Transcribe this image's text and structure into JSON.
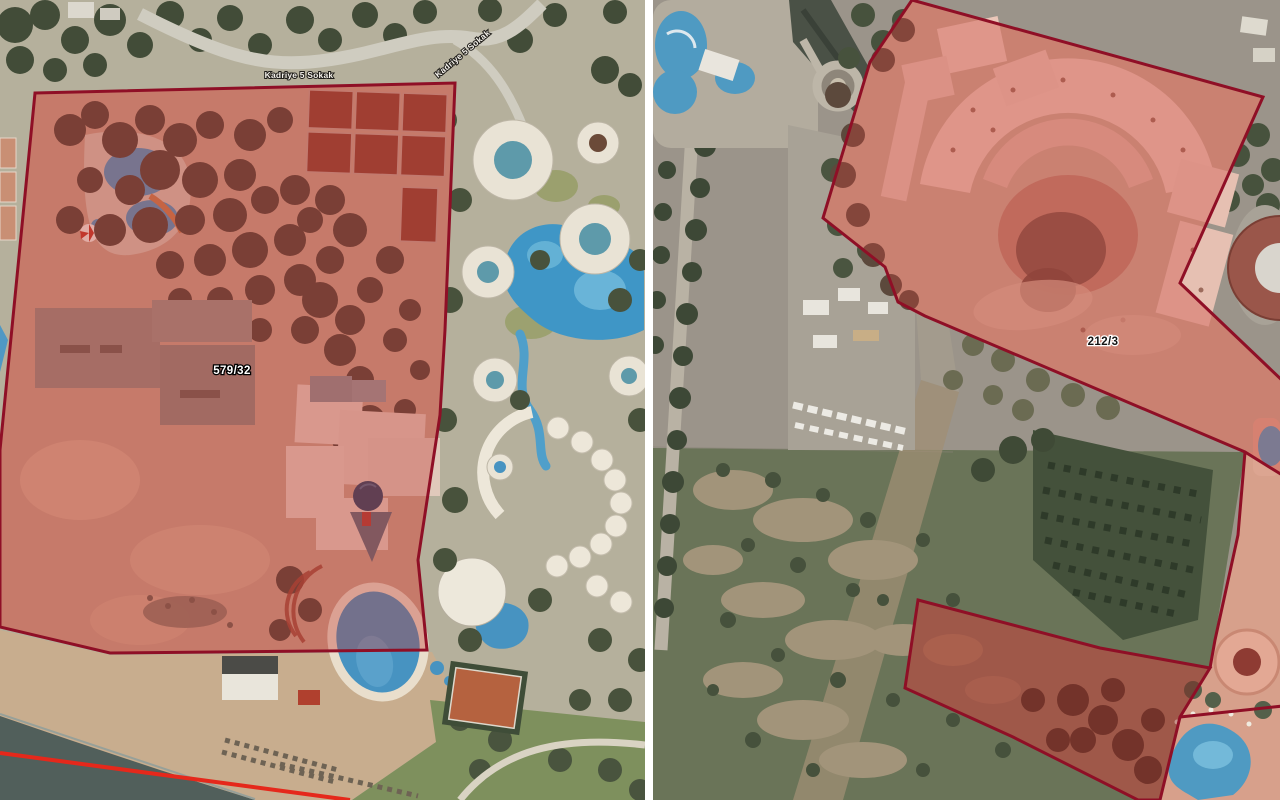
{
  "maps": {
    "left": {
      "parcel": {
        "id": "579/32"
      },
      "street_labels": [
        "Kadriye 5 Sokak",
        "Kadriye 5 Sokak"
      ]
    },
    "right": {
      "parcel": {
        "id": "212/3"
      }
    }
  },
  "colors": {
    "parcel_outline": "#8F0F26",
    "parcel_fill_left": "rgba(193,52,48,0.36)",
    "parcel_fill_right": "rgba(205,66,58,0.36)",
    "parcel_fill_dark": "rgba(146,30,26,0.42)",
    "coastline_red": "#E5281B",
    "divider": "#FFFFFF"
  }
}
